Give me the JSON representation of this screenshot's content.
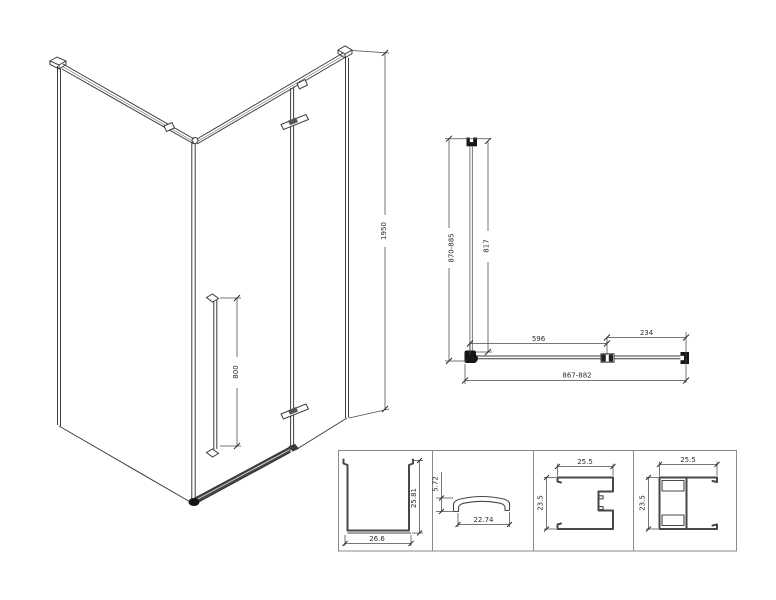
{
  "views": {
    "isometric": {
      "label": "isometric-view",
      "dims": {
        "total_height": "1950",
        "handle_length": "800"
      }
    },
    "plan": {
      "label": "top-plan-view",
      "dims": {
        "side_overall": "870-885",
        "side_glass": "817",
        "door_glass": "596",
        "fixed_panel": "234",
        "front_overall": "867-882"
      }
    },
    "profiles": {
      "label": "profile-sections",
      "cells": [
        {
          "name": "wall-channel-profile",
          "dim_w": "26.6",
          "dim_h": "25.81"
        },
        {
          "name": "threshold-profile",
          "dim_w": "22.74",
          "dim_h": "5.72"
        },
        {
          "name": "wall-profile-female",
          "dim_w": "25.5",
          "dim_h": "23.5"
        },
        {
          "name": "wall-profile-male",
          "dim_w": "25.5",
          "dim_h": "23.5"
        }
      ]
    }
  },
  "colors": {
    "background": "#ffffff",
    "line": "#3c3c3c",
    "dimension": "#4a4a4a",
    "solid_fitting": "#161616"
  }
}
